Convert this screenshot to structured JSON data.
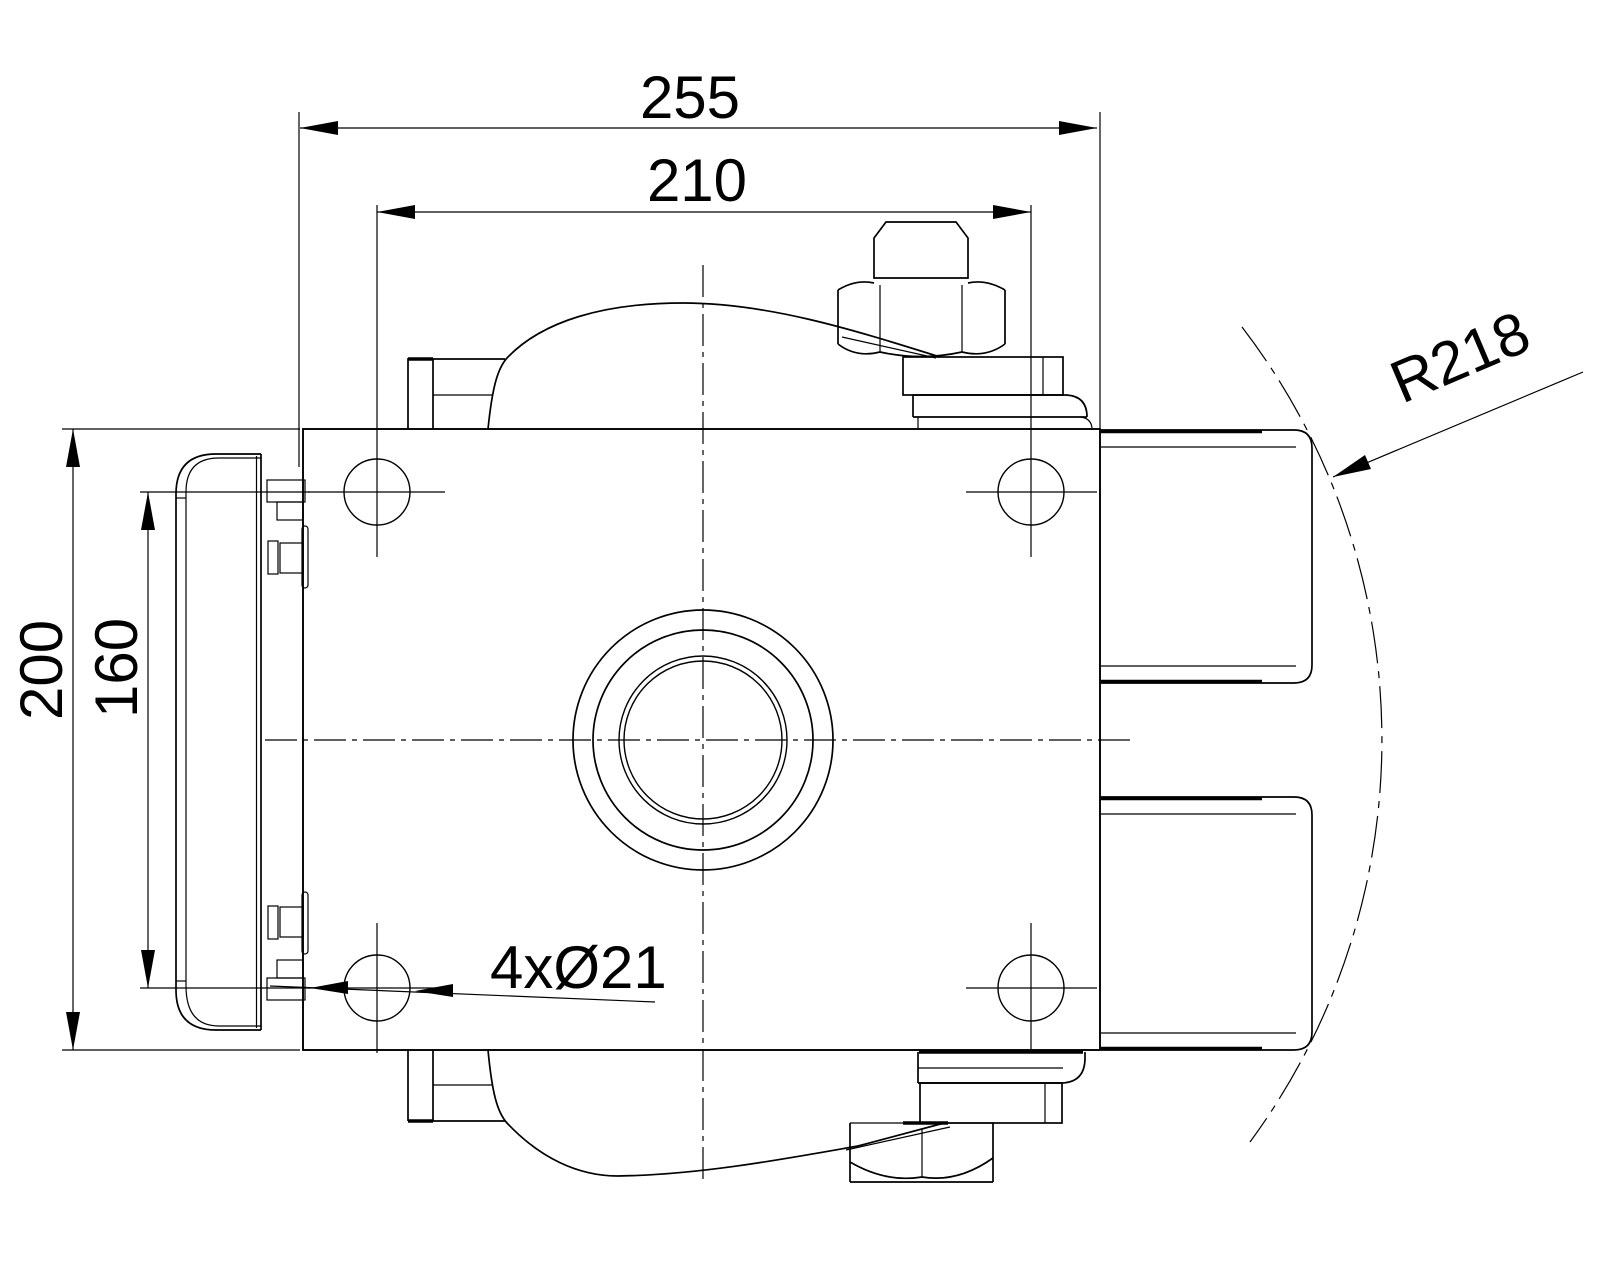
{
  "drawing": {
    "type": "technical-drawing",
    "background_color": "#ffffff",
    "line_color": "#000000",
    "view": "top-view-actuator-mounting-plate",
    "dimensions": {
      "overall_width": {
        "label": "255",
        "orientation": "horizontal"
      },
      "hole_spacing_horizontal": {
        "label": "210",
        "orientation": "horizontal"
      },
      "overall_height": {
        "label": "200",
        "orientation": "vertical"
      },
      "hole_spacing_vertical": {
        "label": "160",
        "orientation": "vertical"
      },
      "mounting_holes": {
        "label": "4xØ21",
        "orientation": "leader"
      },
      "swing_radius": {
        "label": "R218",
        "orientation": "leader-rotated"
      }
    }
  }
}
